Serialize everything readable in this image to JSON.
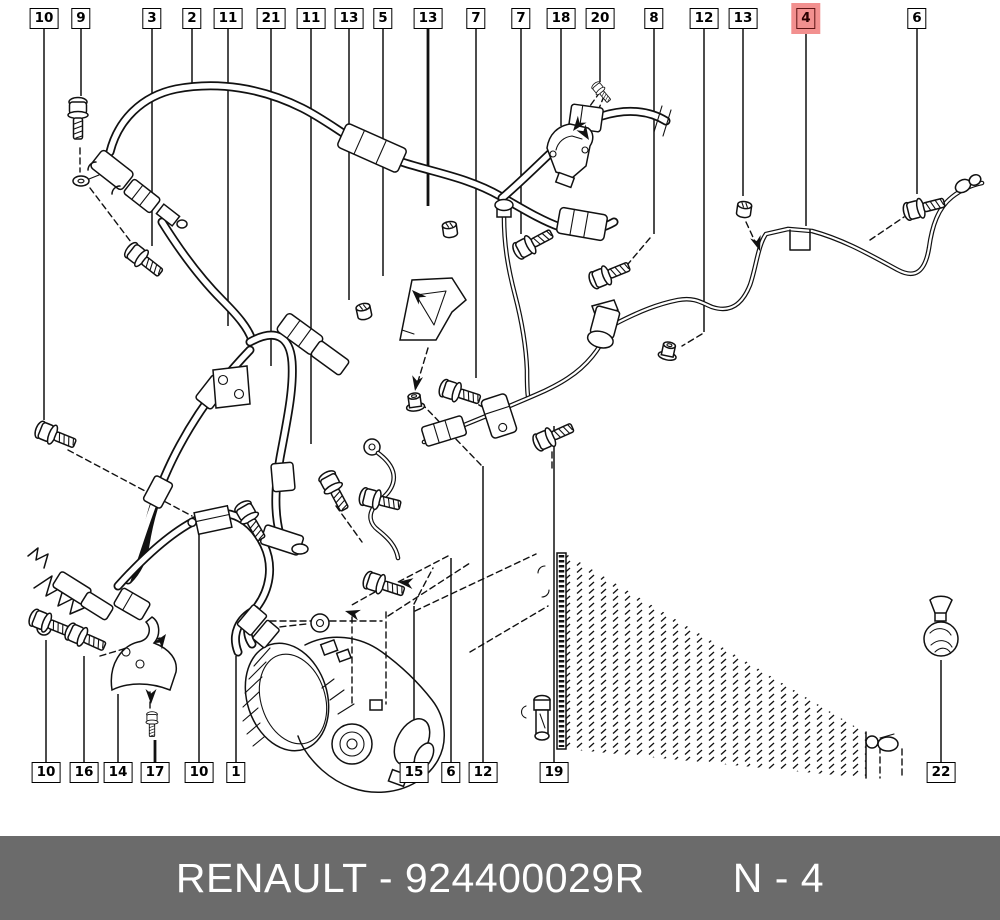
{
  "page": {
    "background": "#ffffff"
  },
  "footer": {
    "brand_part_code": "RENAULT - 924400029R",
    "page_ref": "N - 4",
    "bg_color": "#6b6b6b",
    "text_color": "#ffffff"
  },
  "selection": {
    "selected_part": "4",
    "highlight_fill": "#f2908f",
    "highlight_border": "#5c1212"
  },
  "callouts": {
    "top": [
      {
        "part": "10",
        "x": 44,
        "end": 420
      },
      {
        "part": "9",
        "x": 81,
        "end": 96
      },
      {
        "part": "3",
        "x": 152,
        "end": 246
      },
      {
        "part": "2",
        "x": 192,
        "end": 86
      },
      {
        "part": "11",
        "x": 228,
        "end": 326
      },
      {
        "part": "21",
        "x": 271,
        "end": 366
      },
      {
        "part": "11",
        "x": 311,
        "end": 444
      },
      {
        "part": "13",
        "x": 349,
        "end": 300
      },
      {
        "part": "5",
        "x": 383,
        "end": 276
      },
      {
        "part": "13",
        "x": 428,
        "end": 206,
        "thick": true
      },
      {
        "part": "7",
        "x": 476,
        "end": 378
      },
      {
        "part": "7",
        "x": 521,
        "end": 234
      },
      {
        "part": "18",
        "x": 561,
        "end": 126
      },
      {
        "part": "20",
        "x": 600,
        "end": 82
      },
      {
        "part": "8",
        "x": 654,
        "end": 234
      },
      {
        "part": "12",
        "x": 704,
        "end": 332
      },
      {
        "part": "13",
        "x": 743,
        "end": 196
      },
      {
        "part": "4",
        "x": 806,
        "end": 226,
        "selected": true
      },
      {
        "part": "6",
        "x": 917,
        "end": 194
      }
    ],
    "bottom": [
      {
        "part": "10",
        "x": 46,
        "end": 640
      },
      {
        "part": "16",
        "x": 84,
        "end": 656
      },
      {
        "part": "14",
        "x": 118,
        "end": 694
      },
      {
        "part": "17",
        "x": 155,
        "end": 740,
        "thick": true
      },
      {
        "part": "10",
        "x": 199,
        "end": 534
      },
      {
        "part": "1",
        "x": 236,
        "end": 656
      },
      {
        "part": "15",
        "x": 414,
        "end": 606
      },
      {
        "part": "6",
        "x": 451,
        "end": 558
      },
      {
        "part": "12",
        "x": 483,
        "end": 466
      },
      {
        "part": "19",
        "x": 554,
        "end": 426
      },
      {
        "part": "22",
        "x": 941,
        "end": 660
      }
    ]
  }
}
